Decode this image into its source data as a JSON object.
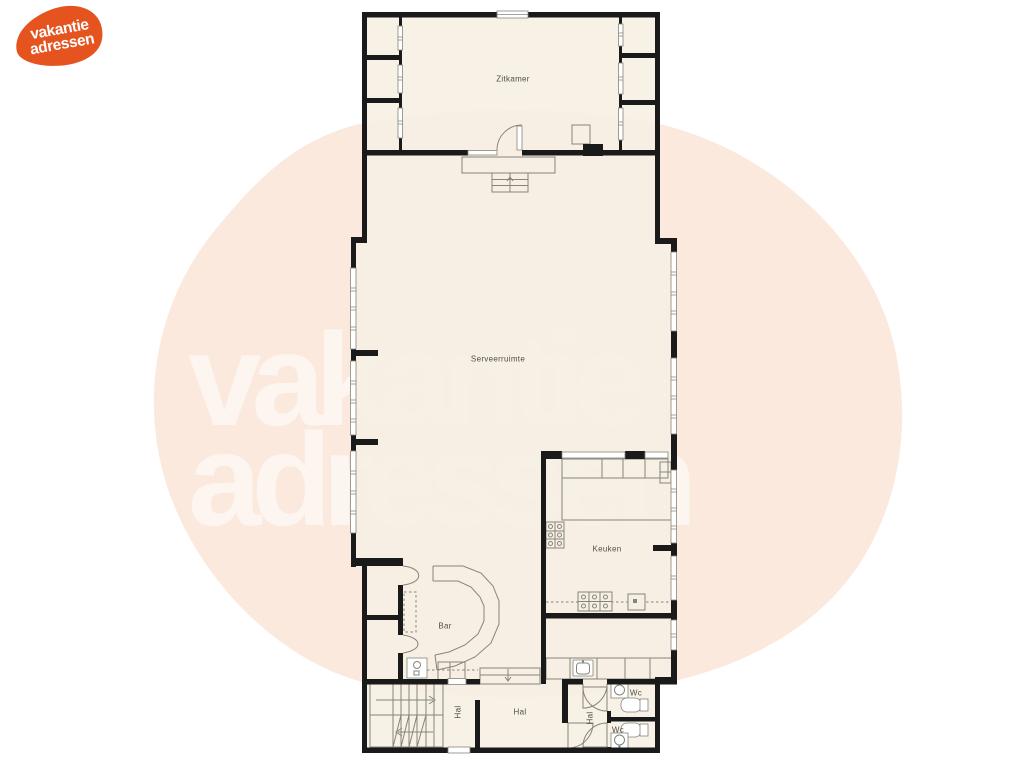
{
  "watermark": {
    "line1": "vakantie",
    "line2": "adressen"
  },
  "logo": {
    "line1": "vakantie",
    "line2": "adressen"
  },
  "rooms": {
    "zitkamer": "Zitkamer",
    "serveerruimte": "Serveerruimte",
    "keuken": "Keuken",
    "bar": "Bar",
    "hal_main": "Hal",
    "hal_corridor": "Hal",
    "hal_small": "Hal",
    "wc_top": "Wc",
    "wc_bottom": "Wc"
  },
  "colors": {
    "blob": "#fbe9dd",
    "floor": "#f6efe3",
    "wall": "#1a1a1a",
    "line": "#85857c",
    "label": "#4f4f48",
    "logo_orange": "#e5531f",
    "watermark_white": "#ffffff"
  }
}
